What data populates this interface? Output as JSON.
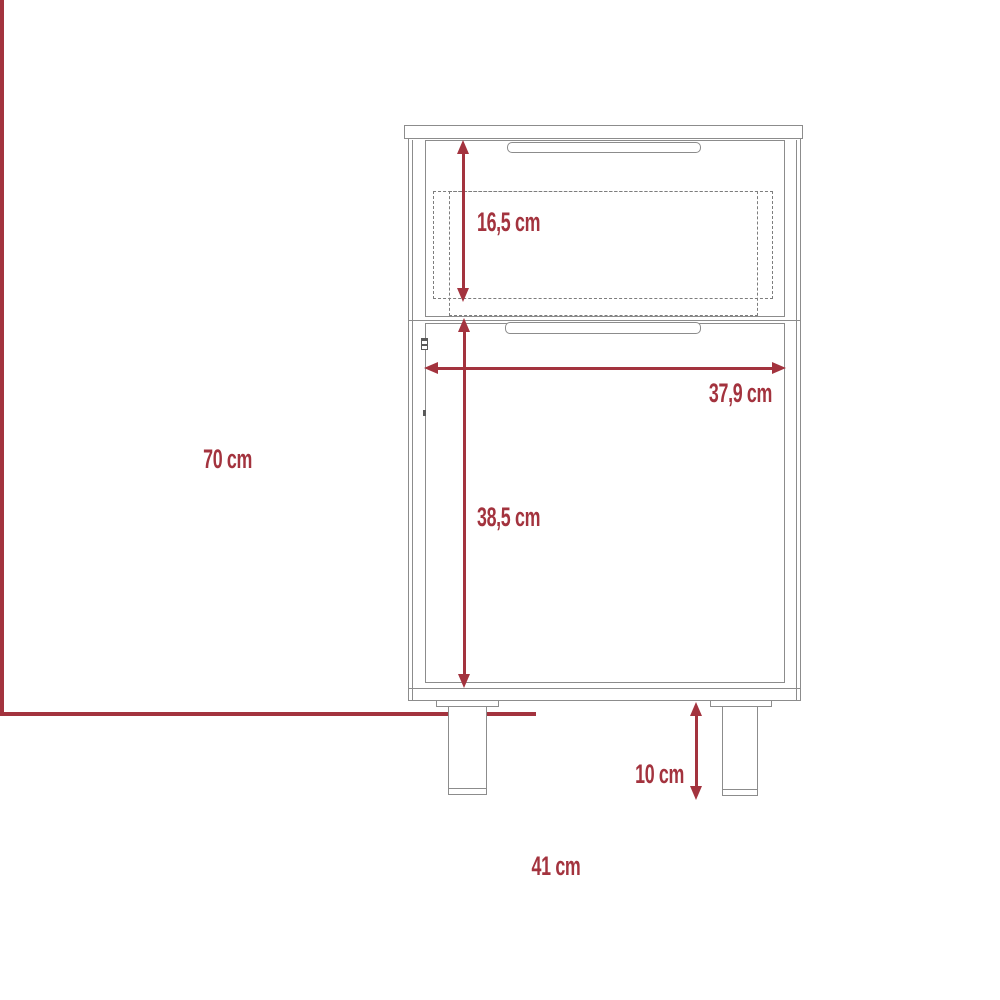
{
  "drawing": {
    "type": "furniture-dimension-diagram",
    "subject": "nightstand with drawer, door and two legs",
    "colors": {
      "dimension_accent": "#a3333e",
      "furniture_outline": "#8c8c8c",
      "background": "#ffffff"
    },
    "labels": {
      "overall_height": "70 cm",
      "overall_width": "41 cm",
      "drawer_height": "16,5 cm",
      "interior_width": "37,9 cm",
      "door_height": "38,5 cm",
      "leg_height": "10 cm"
    }
  }
}
